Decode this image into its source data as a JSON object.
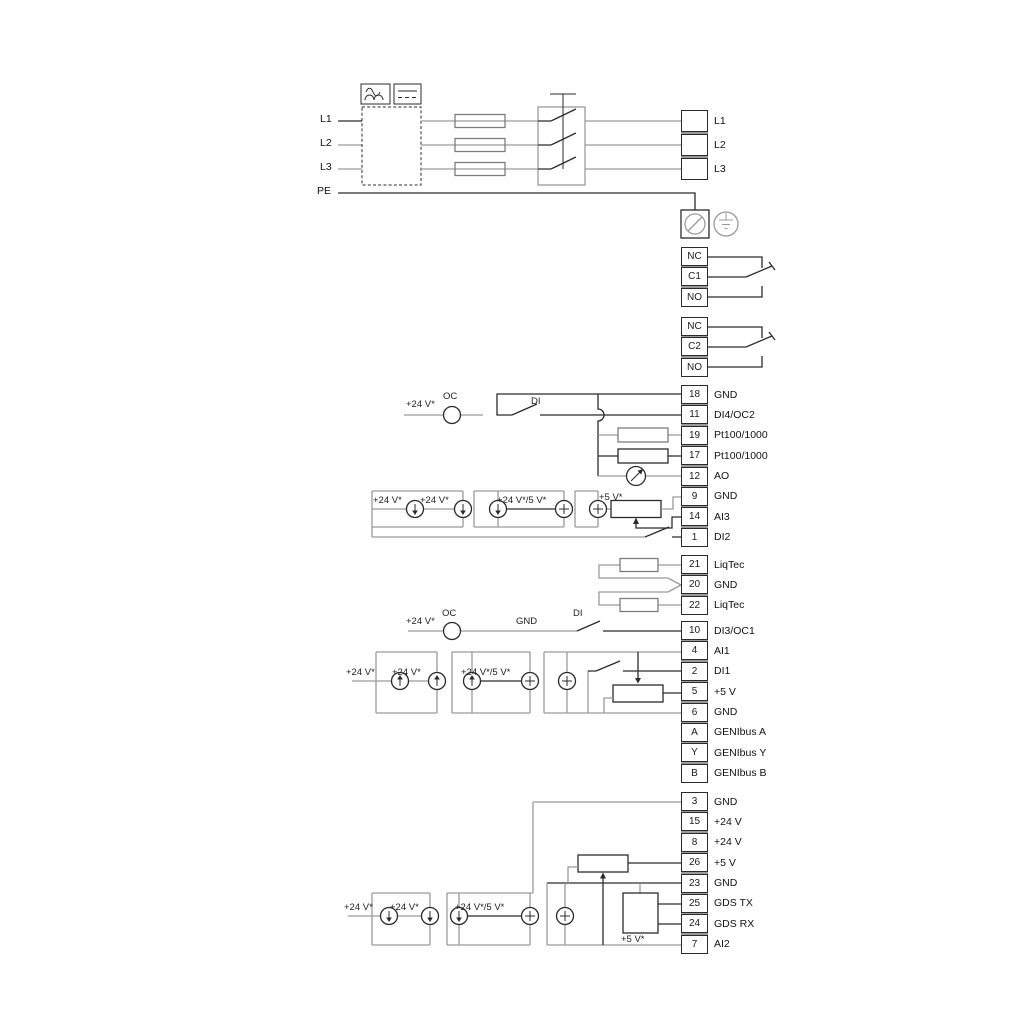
{
  "diagram": {
    "power_in": {
      "l1": "L1",
      "l2": "L2",
      "l3": "L3",
      "pe": "PE"
    },
    "strips": {
      "mains": {
        "rows": [
          {
            "num": "",
            "label": "L1"
          },
          {
            "num": "",
            "label": "L2"
          },
          {
            "num": "",
            "label": "L3"
          }
        ]
      },
      "relay1": {
        "rows": [
          {
            "num": "NC",
            "label": ""
          },
          {
            "num": "C1",
            "label": ""
          },
          {
            "num": "NO",
            "label": ""
          }
        ]
      },
      "relay2": {
        "rows": [
          {
            "num": "NC",
            "label": ""
          },
          {
            "num": "C2",
            "label": ""
          },
          {
            "num": "NO",
            "label": ""
          }
        ]
      },
      "io_a": {
        "rows": [
          {
            "num": "18",
            "label": "GND"
          },
          {
            "num": "11",
            "label": "DI4/OC2"
          },
          {
            "num": "19",
            "label": "Pt100/1000"
          },
          {
            "num": "17",
            "label": "Pt100/1000"
          },
          {
            "num": "12",
            "label": "AO"
          },
          {
            "num": "9",
            "label": "GND"
          },
          {
            "num": "14",
            "label": "AI3"
          },
          {
            "num": "1",
            "label": "DI2"
          }
        ]
      },
      "liqtec": {
        "rows": [
          {
            "num": "21",
            "label": "LiqTec"
          },
          {
            "num": "20",
            "label": "GND"
          },
          {
            "num": "22",
            "label": "LiqTec"
          }
        ]
      },
      "io_b": {
        "rows": [
          {
            "num": "10",
            "label": "DI3/OC1"
          },
          {
            "num": "4",
            "label": "AI1"
          },
          {
            "num": "2",
            "label": "DI1"
          },
          {
            "num": "5",
            "label": "+5 V"
          },
          {
            "num": "6",
            "label": "GND"
          },
          {
            "num": "A",
            "label": "GENIbus A"
          },
          {
            "num": "Y",
            "label": "GENIbus Y"
          },
          {
            "num": "B",
            "label": "GENIbus B"
          }
        ]
      },
      "io_c": {
        "rows": [
          {
            "num": "3",
            "label": "GND"
          },
          {
            "num": "15",
            "label": "+24 V"
          },
          {
            "num": "8",
            "label": "+24 V"
          },
          {
            "num": "26",
            "label": "+5 V"
          },
          {
            "num": "23",
            "label": "GND"
          },
          {
            "num": "25",
            "label": "GDS TX"
          },
          {
            "num": "24",
            "label": "GDS RX"
          },
          {
            "num": "7",
            "label": "AI2"
          }
        ]
      }
    },
    "annotations": {
      "oc_a_plus24": "+24 V*",
      "oc_a": "OC",
      "di_a": "DI",
      "m_a_1": "+24 V*",
      "m_a_2": "+24 V*",
      "m_a_3": "+24 V*/5 V*",
      "m_a_4": "+5 V*",
      "oc_b_plus24": "+24 V*",
      "oc_b": "OC",
      "gnd_b": "GND",
      "di_b": "DI",
      "m_b_1": "+24 V*",
      "m_b_2": "+24 V*",
      "m_b_3": "+24 V*/5 V*",
      "m_c_1": "+24 V*",
      "m_c_2": "+24 V*",
      "m_c_3": "+24 V*/5 V*",
      "m_c_4": "+5 V*"
    },
    "colors": {
      "wire_gray": "#9a9a9a",
      "wire_dark": "#2b2b2b",
      "background": "#ffffff"
    }
  }
}
